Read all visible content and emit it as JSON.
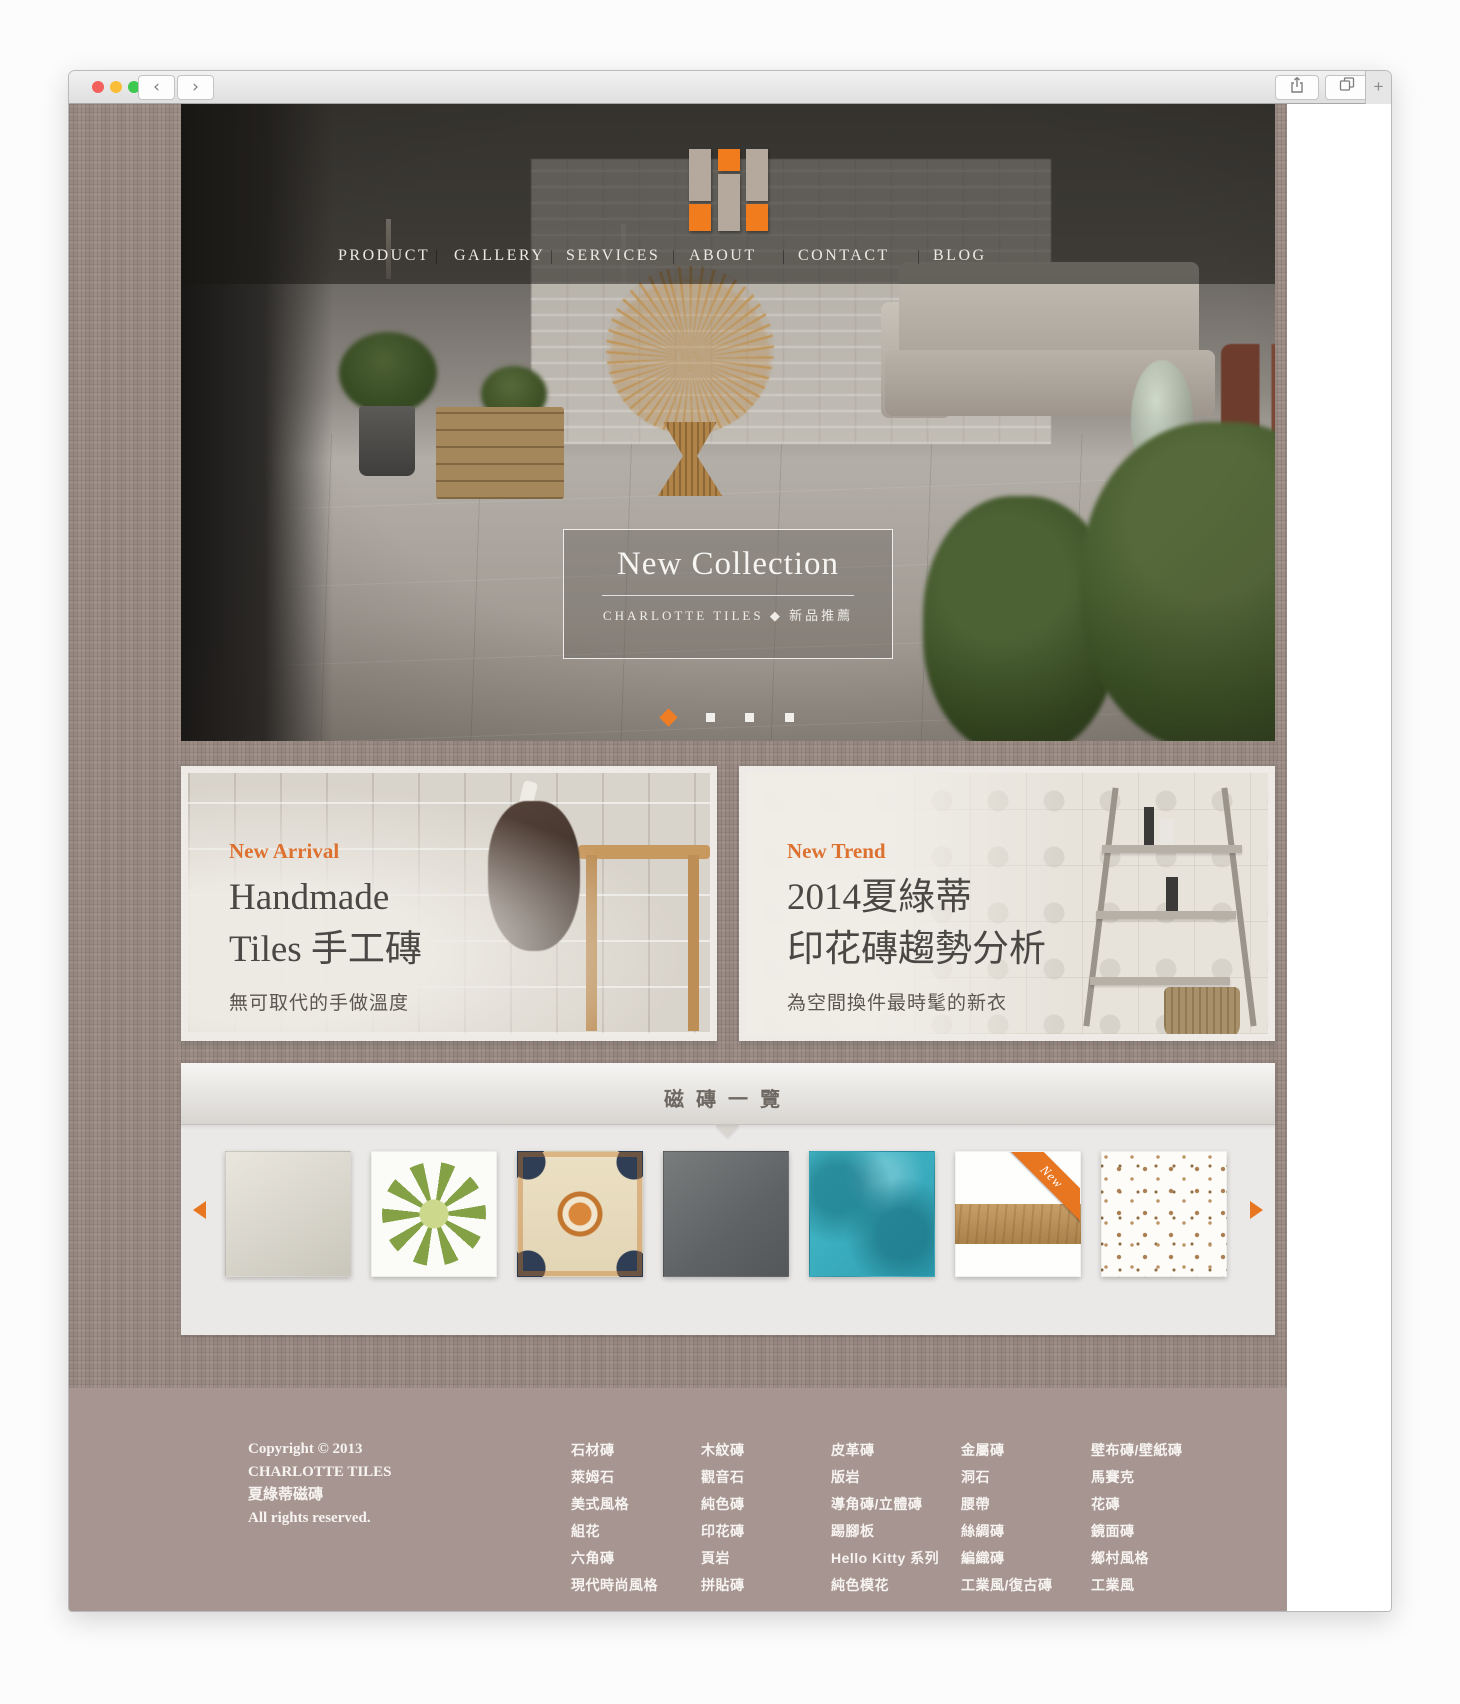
{
  "colors": {
    "accent_orange": "#e8751f",
    "logo_orange": "#f07c1e",
    "logo_beige": "#b5a89d",
    "band_base": "#9c8d86",
    "footer_bg": "#a69590"
  },
  "browser": {
    "back_label": "‹",
    "forward_label": "›",
    "new_tab_label": "+"
  },
  "nav": {
    "items": [
      "PRODUCT",
      "GALLERY",
      "SERVICES",
      "ABOUT",
      "CONTACT",
      "BLOG"
    ]
  },
  "hero": {
    "banner_title": "New Collection",
    "banner_subtitle": "CHARLOTTE TILES ◆ 新品推薦",
    "dots_count": 4,
    "active_dot_index": 0
  },
  "cards": [
    {
      "tag": "New Arrival",
      "line1": "Handmade",
      "line2": "Tiles 手工磚",
      "desc": "無可取代的手做溫度"
    },
    {
      "tag": "New Trend",
      "line1": "2014夏綠蒂",
      "line2": "印花磚趨勢分析",
      "desc": "為空間換件最時髦的新衣"
    }
  ],
  "carousel": {
    "title": "磁磚一覽",
    "new_badge": "New",
    "tiles": [
      "plain-cream-tile",
      "green-flower-tile",
      "ornate-moroccan-tile",
      "dark-concrete-tile",
      "turquoise-tile",
      "wood-plank-tile",
      "toile-pattern-tile"
    ]
  },
  "footer": {
    "copyright": [
      "Copyright © 2013",
      "CHARLOTTE TILES",
      "夏綠蒂磁磚",
      "All rights reserved."
    ],
    "columns": [
      [
        "石材磚",
        "萊姆石",
        "美式風格",
        "組花",
        "六角磚",
        "現代時尚風格"
      ],
      [
        "木紋磚",
        "觀音石",
        "純色磚",
        "印花磚",
        "頁岩",
        "拼貼磚"
      ],
      [
        "皮革磚",
        "版岩",
        "導角磚/立體磚",
        "踢腳板",
        "Hello Kitty 系列",
        "純色模花"
      ],
      [
        "金屬磚",
        "洞石",
        "腰帶",
        "絲綢磚",
        "編織磚",
        "工業風/復古磚"
      ],
      [
        "壁布磚/壁紙磚",
        "馬賽克",
        "花磚",
        "鏡面磚",
        "鄉村風格",
        "工業風"
      ]
    ]
  }
}
